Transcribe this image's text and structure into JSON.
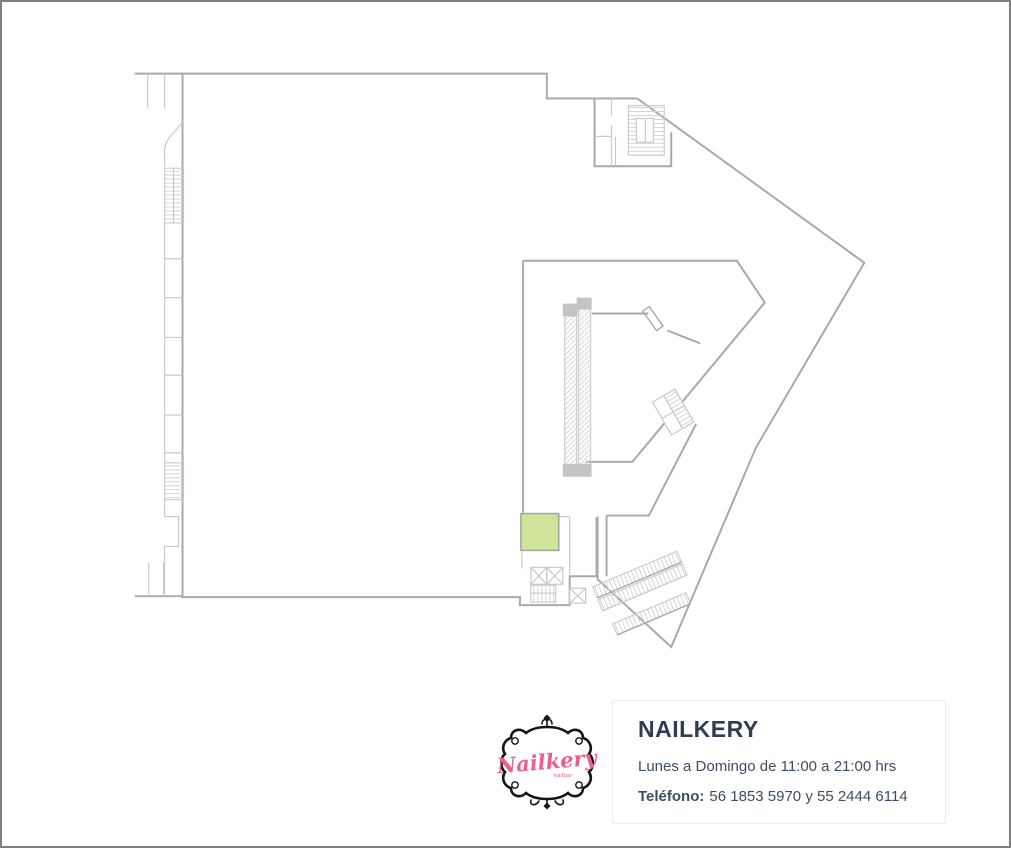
{
  "colors": {
    "page_border": "#7f7f7f",
    "wall": "#a9a9a9",
    "wall_light": "#c9c9c9",
    "highlight_fill": "#cfe49b",
    "highlight_stroke": "#a2a2a2",
    "card_border": "#ededed",
    "title_text": "#2d3e50",
    "body_text": "#3c4e61",
    "accent": "#ec5f8f",
    "logo_frame": "#151515"
  },
  "store_card": {
    "title": "NAILKERY",
    "hours": "Lunes a Domingo de 11:00 a 21:00 hrs",
    "phone_label": "Teléfono:",
    "phone_value": "56 1853 5970 y 55 2444 6114",
    "logo_brand": "Nailkery",
    "logo_tagline": "nailbar"
  }
}
